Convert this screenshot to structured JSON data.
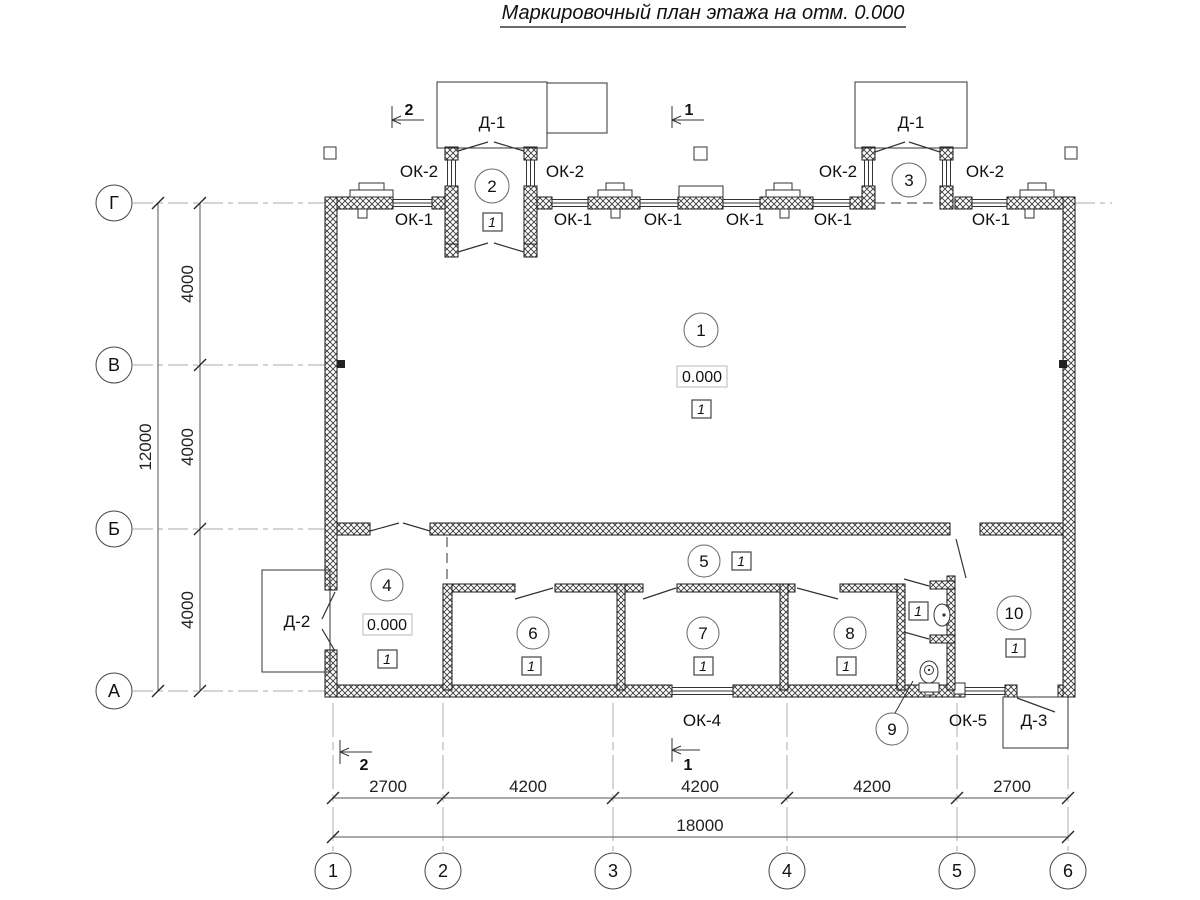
{
  "title": "Маркировочный план этажа на отм. 0.000",
  "room_numbers": [
    "1",
    "2",
    "3",
    "4",
    "5",
    "6",
    "7",
    "8",
    "9",
    "10"
  ],
  "floor_type_mark": "1",
  "elevation_mark": "0.000",
  "window_labels": {
    "ok1": "ОК-1",
    "ok2": "ОК-2",
    "ok4": "ОК-4",
    "ok5": "ОК-5"
  },
  "door_labels": {
    "d1": "Д-1",
    "d2": "Д-2",
    "d3": "Д-3"
  },
  "section_marks": {
    "one": "1",
    "two": "2"
  },
  "axes": {
    "bottom": [
      "1",
      "2",
      "3",
      "4",
      "5",
      "6"
    ],
    "left": [
      "Г",
      "В",
      "Б",
      "А"
    ]
  },
  "dimensions": {
    "bottom_segments": [
      "2700",
      "4200",
      "4200",
      "4200",
      "2700"
    ],
    "bottom_total": "18000",
    "left_segments": [
      "4000",
      "4000",
      "4000"
    ],
    "left_total": "12000"
  }
}
